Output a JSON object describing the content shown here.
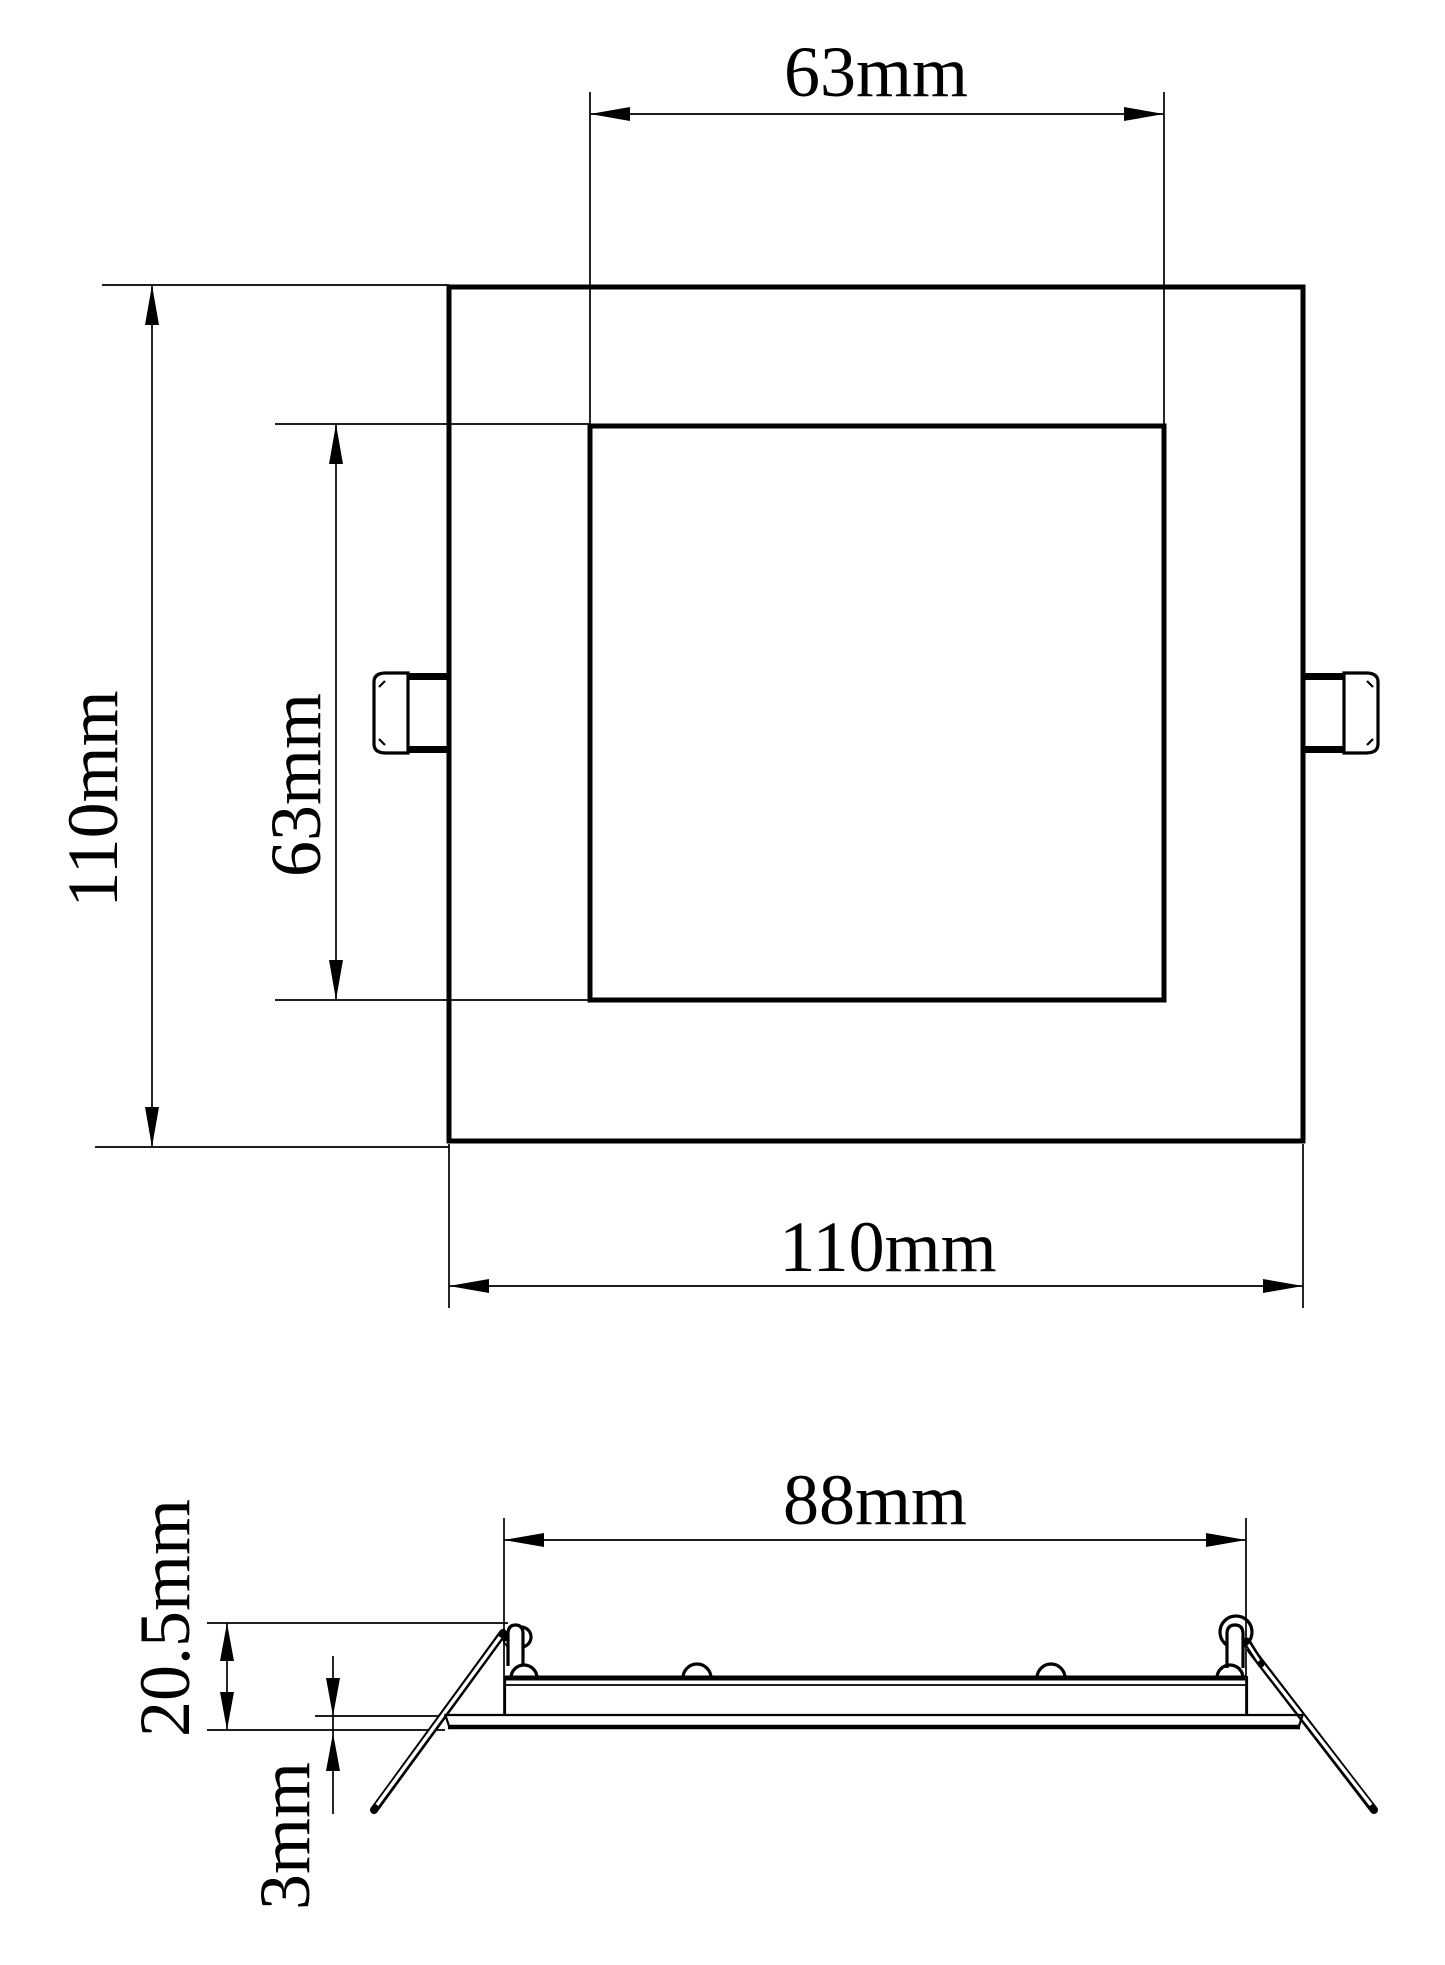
{
  "drawing": {
    "colors": {
      "line": "#000000",
      "background": "#ffffff"
    },
    "front_view": {
      "cutout_width_label": "63mm",
      "overall_height_label": "110mm",
      "cutout_height_label": "63mm",
      "overall_width_label": "110mm"
    },
    "side_view": {
      "recess_width_label": "88mm",
      "overall_depth_label": "20.5mm",
      "flange_thickness_label": "3mm"
    }
  }
}
